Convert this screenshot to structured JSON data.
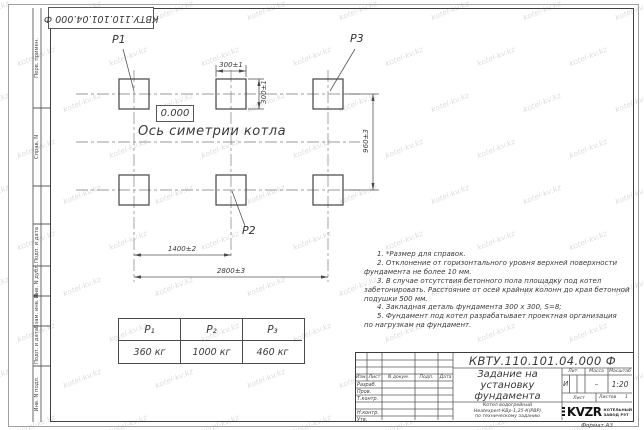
{
  "watermark": {
    "text": "kotel-kv.kz"
  },
  "top_stamp": {
    "designation": "КВТУ.110.101.04.000 Ф"
  },
  "margin_fields": {
    "items": [
      {
        "label": "Перв. примен."
      },
      {
        "label": "Справ. N"
      },
      {
        "label": "Подп. и дата"
      },
      {
        "label": "Инв. N дубл."
      },
      {
        "label": "Взам. инв. N"
      },
      {
        "label": "Подп. и дата"
      },
      {
        "label": "Инв. N подл."
      }
    ]
  },
  "drawing": {
    "labels": {
      "p1": "P1",
      "p2": "P2",
      "p3": "P3"
    },
    "elevation": "0.000",
    "axis_label": "Ось симетрии котла",
    "dimensions": {
      "width_top": "300±1",
      "height_top": "300±1",
      "vertical_span": "960±3",
      "mid_span": "1400±2",
      "full_span": "2800±3"
    }
  },
  "notes": {
    "line1": "1. *Размер для справок.",
    "line2": "2. Отклонение от горизонтального уровня верхней поверхности",
    "line3": "фундамента не более 10 мм.",
    "line4": "3. В случае отсутствия бетонного пола площадку под котел",
    "line5": "забетонировать. Расстояние от осей крайних колонн до края бетонной",
    "line6": "подушки 500 мм.",
    "line7": "4. Закладная деталь фундамента 300 х 300, S=8;",
    "line8": "5. Фундамент под котел разрабатывает проектная организация",
    "line9": "по нагрузкам на фундамент."
  },
  "load_table": {
    "headers": [
      "P₁",
      "P₂",
      "P₃"
    ],
    "values": [
      "360 кг",
      "1000 кг",
      "460 кг"
    ]
  },
  "title_block": {
    "designation": "КВТУ.110.101.04.000 Ф",
    "doc_title": "Задание на установку фундамента",
    "product_line1": "Котел водогрейный",
    "product_line2": "Heatexpert-КВр-1,25-К(РВР)",
    "product_line3": "по техническому заданию",
    "col_izm": "Изм.",
    "col_list": "Лист",
    "col_doc": "N докум.",
    "col_podp": "Подп.",
    "col_data": "Дата",
    "row_razrab": "Разраб.",
    "row_prov": "Пров.",
    "row_tkontr": "Т.контр.",
    "row_nkontr": "Н.контр.",
    "row_utv": "Утв.",
    "lit_label": "Лит.",
    "mass_label": "Масса",
    "scale_label": "Масштаб",
    "lit_value": "И",
    "mass_value": "–",
    "scale_value": "1:20",
    "sheet_label": "Лист",
    "sheets_label": "Листов",
    "sheets_value": "1",
    "logo_text": "KVZR",
    "company_line1": "КОТЕЛЬНЫЙ",
    "company_line2": "ЗАВОД РЭТ",
    "format_label": "Формат А3"
  }
}
